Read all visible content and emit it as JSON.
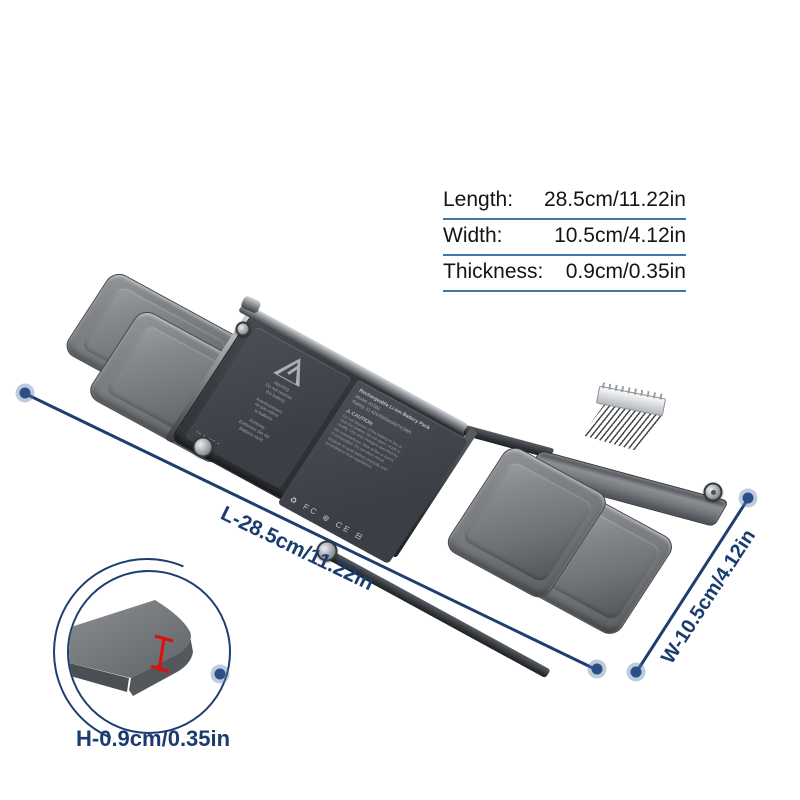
{
  "spec_table": {
    "rows": [
      {
        "label": "Length:",
        "value": "28.5cm/11.22in"
      },
      {
        "label": "Width:",
        "value": "10.5cm/4.12in"
      },
      {
        "label": "Thickness:",
        "value": "0.9cm/0.35in"
      }
    ]
  },
  "dimensions": {
    "length_label": "L-28.5cm/11.22in",
    "width_label": "W-10.5cm/4.12in",
    "height_label": "H-0.9cm/0.35in"
  },
  "battery": {
    "warning_panel": {
      "lines": [
        "Warning:",
        "Do not remove",
        "the battery",
        "Avertissement:",
        "ne pas retirer",
        "la batterie",
        "Achtung:",
        "Entfernen Sie die",
        "Batterie nicht"
      ],
      "footer_marks": "▪▪ ▪ ▪▪▪ ▪"
    },
    "info_panel": {
      "title": "Rechargeable Li-ion Battery Pack",
      "model": "Model: A1582",
      "rating": "Rating: 11.42V/6559mAh/74.9Wh",
      "caution_heading": "⚠ CAUTION:",
      "caution_lines": [
        "Do not dispose of the battery in fire or",
        "heat the battery. Do not open, crush or",
        "modify. Use only chargers specified by",
        "the manufacturer. Risk of fire or burns",
        "if mishandled. Do not short circuit.",
        "Dispose of used battery promptly and",
        "according to local regulations."
      ],
      "cert_marks": "♻ FC ⊗ CE ⊟"
    }
  },
  "colors": {
    "annotation_navy": "#1d3e6f",
    "table_underline_blue": "#4076a8",
    "thickness_marker_red": "#e30d0d",
    "battery_gray": "#77797b",
    "panel_charcoal": "#3e4146",
    "background": "#ffffff"
  }
}
